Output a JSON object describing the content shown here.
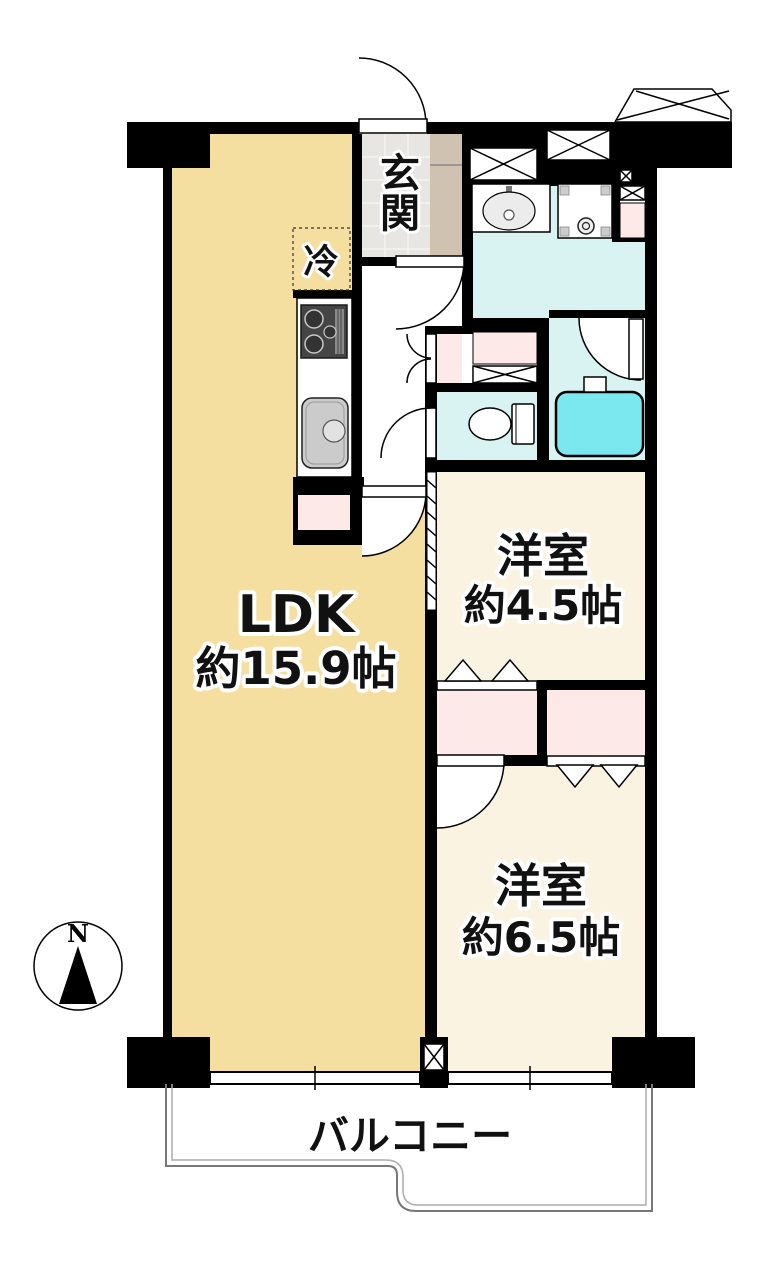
{
  "plan": {
    "compass_label": "N",
    "balcony_label": "バルコニー",
    "entrance_label": "玄関",
    "fridge_label": "冷",
    "ldk": {
      "name": "LDK",
      "area": "約15.9帖"
    },
    "room_small": {
      "name": "洋室",
      "area": "約4.5帖"
    },
    "room_large": {
      "name": "洋室",
      "area": "約6.5帖"
    }
  },
  "colors": {
    "ldk_floor": "#f4dea0",
    "western_room_floor": "#faf3e1",
    "wet_area_floor": "#d9f3f2",
    "bathtub": "#7be8f0",
    "closet_pink": "#fce9e8",
    "entrance_tile": "#e7e6e3",
    "shoe_cabinet": "#cfc2b0",
    "wall": "#000000",
    "balcony_line": "#777777"
  }
}
